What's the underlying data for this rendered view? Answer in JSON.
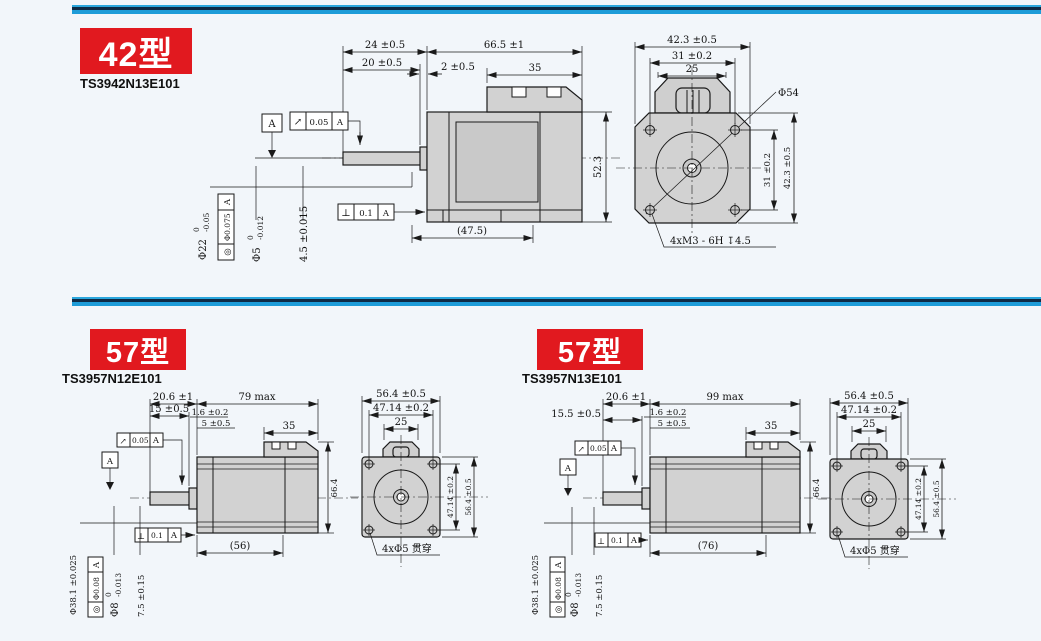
{
  "page": {
    "background": "#f2f6fa",
    "divider_blue": "#1e9cd8",
    "divider_navy": "#0e2b46",
    "badge_red": "#e1191f",
    "line_color": "#1a1a1a",
    "metal_fill": "#d2d2d2"
  },
  "sections": {
    "s42": {
      "badge": "42型",
      "model": "TS3942N13E101",
      "side": {
        "shaft_total": "24 ±0.5",
        "shaft_len": "20 ±0.5",
        "pilot_len": "2 ±0.5",
        "body_len": "66.5 ±1",
        "rear_len": "35",
        "height": "52.3",
        "frame_len": "(47.5)",
        "datum": "A",
        "runout_sym": "↗",
        "runout_val": "0.05",
        "runout_ref": "A",
        "perp_sym": "⊥",
        "perp_val": "0.1",
        "perp_ref": "A",
        "boss_dia": "Φ22",
        "boss_tol_up": "0",
        "boss_tol_lo": "-0.05",
        "conc_sym": "◎",
        "conc_val": "Φ0.075",
        "conc_ref": "A",
        "shaft_dia": "Φ5",
        "shaft_tol_up": "0",
        "shaft_tol_lo": "-0.012",
        "flat_len": "4.5 ±0.015"
      },
      "front": {
        "width": "42.3 ±0.5",
        "pitch": "31 ±0.2",
        "top_width": "25",
        "pitch_v": "31 ±0.2",
        "height": "42.3 ±0.5",
        "diagonal": "Φ54",
        "hole_note": "4xM3 - 6H ↧4.5"
      }
    },
    "s57a": {
      "badge": "57型",
      "model": "TS3957N12E101",
      "side": {
        "shaft_total": "20.6 ±1",
        "body_len": "79 max",
        "shaft_len": "15 ±0.5",
        "step_len": "1.6 ±0.2",
        "pilot_len": "5 ±0.5",
        "rear_len": "35",
        "height": "66.4",
        "frame_len": "(56)",
        "datum": "A",
        "runout_sym": "↗",
        "runout_val": "0.05",
        "runout_ref": "A",
        "perp_sym": "⊥",
        "perp_val": "0.1",
        "perp_ref": "A",
        "boss_dia": "Φ38.1 ±0.025",
        "conc_sym": "◎",
        "conc_val": "Φ0.08",
        "conc_ref": "A",
        "shaft_dia": "Φ8",
        "shaft_tol_up": "0",
        "shaft_tol_lo": "-0.013",
        "flat_len": "7.5 ±0.15"
      },
      "front": {
        "width": "56.4 ±0.5",
        "pitch": "47.14 ±0.2",
        "top_width": "25",
        "pitch_v": "47.14 ±0.2",
        "height": "56.4 ±0.5",
        "hole_note": "4xΦ5 贯穿"
      }
    },
    "s57b": {
      "badge": "57型",
      "model": "TS3957N13E101",
      "side": {
        "shaft_total": "20.6 ±1",
        "body_len": "99 max",
        "shaft_len": "15.5 ±0.5",
        "step_len": "1.6 ±0.2",
        "pilot_len": "5 ±0.5",
        "rear_len": "35",
        "height": "66.4",
        "frame_len": "(76)",
        "datum": "A",
        "runout_sym": "↗",
        "runout_val": "0.05",
        "runout_ref": "A",
        "perp_sym": "⊥",
        "perp_val": "0.1",
        "perp_ref": "A",
        "boss_dia": "Φ38.1 ±0.025",
        "conc_sym": "◎",
        "conc_val": "Φ0.08",
        "conc_ref": "A",
        "shaft_dia": "Φ8",
        "shaft_tol_up": "0",
        "shaft_tol_lo": "-0.013",
        "flat_len": "7.5 ±0.15"
      },
      "front": {
        "width": "56.4 ±0.5",
        "pitch": "47.14 ±0.2",
        "top_width": "25",
        "pitch_v": "47.14 ±0.2",
        "height": "56.4 ±0.5",
        "hole_note": "4xΦ5 贯穿"
      }
    }
  }
}
